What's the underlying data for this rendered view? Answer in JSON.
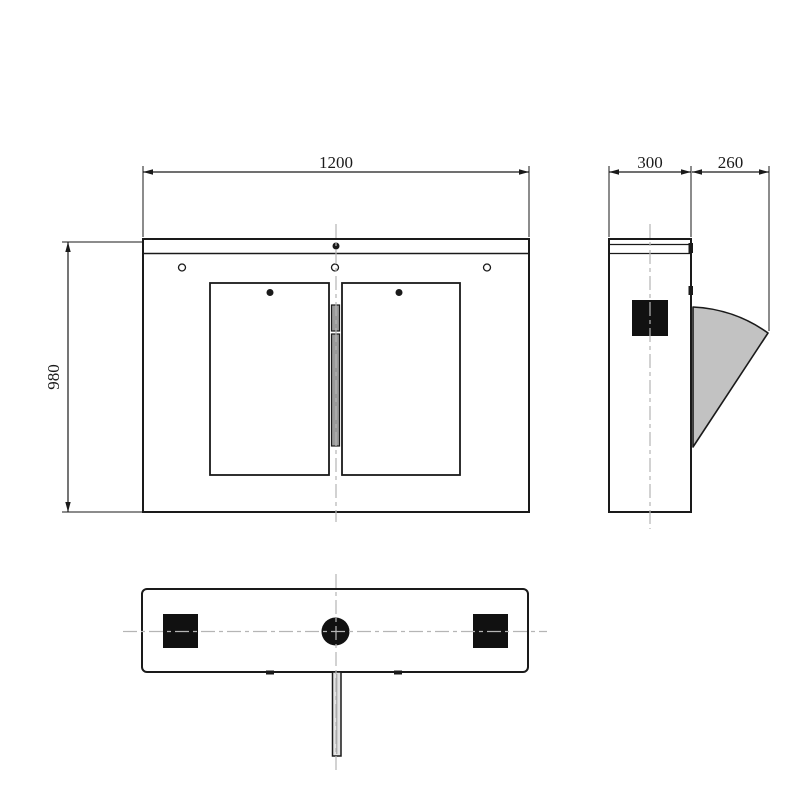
{
  "drawing": {
    "type": "engineering-drawing",
    "subject": "flap-barrier-turnstile-three-view",
    "dimensions": {
      "width": "1200",
      "height": "980",
      "depth": "300",
      "flap_extension": "260"
    },
    "colors": {
      "line": "#1a1a1a",
      "centerline": "#b5b5b5",
      "flap_fill": "#c2c2c2",
      "hinge_fill": "#9a9a9a",
      "background": "#ffffff"
    }
  }
}
